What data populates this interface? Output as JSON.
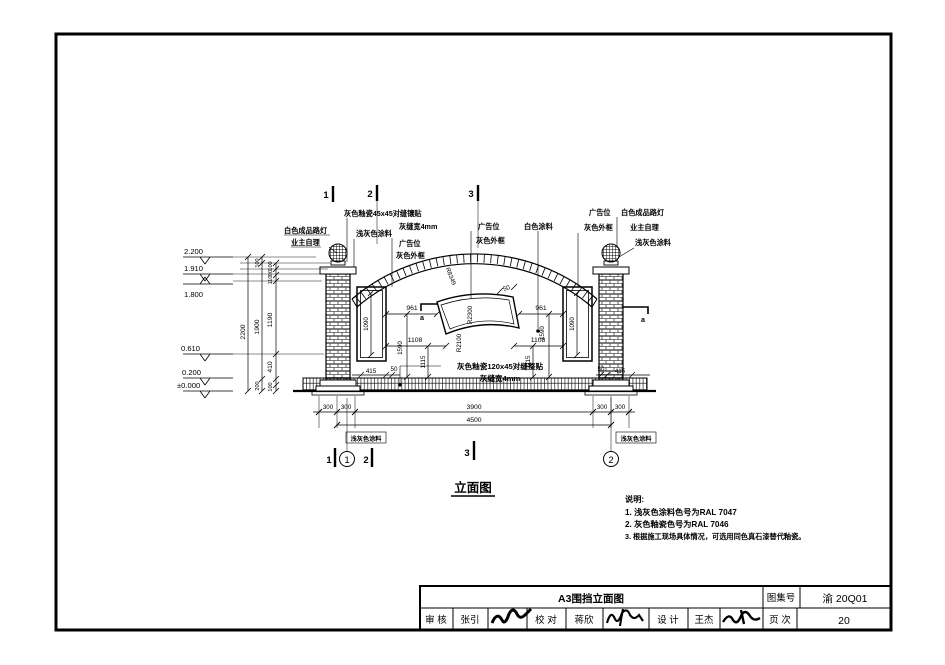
{
  "drawing": {
    "title": "立面图",
    "levels": {
      "l2200": "2.200",
      "l1910": "1.910",
      "l1800": "1.800",
      "l0610": "0.610",
      "l0200": "0.200",
      "l0000": "±0.000"
    },
    "axis": {
      "n1": "1",
      "n2": "2",
      "n3": "3",
      "a": "a"
    },
    "labels": {
      "lamp1": "白色成品路灯",
      "lamp2": "业主自理",
      "tile45": "灰色釉瓷45x45对缝镶贴",
      "joint4": "灰缝宽4mm",
      "paint_lightgray": "浅灰色涂料",
      "ad": "广告位",
      "ad_frame": "灰色外框",
      "paint_white": "白色涂料",
      "tile120": "灰色釉瓷120x45对缝整贴"
    },
    "dims": {
      "v2200": "2200",
      "v1900": "1900",
      "v200": "200",
      "c100a": "100",
      "c90": "90",
      "c110": "110",
      "c1190": "1190",
      "c410": "410",
      "c100b": "100",
      "p1090": "1090",
      "d961": "961",
      "d1108": "1108",
      "d1115": "1115",
      "d1590": "1590",
      "d415": "415",
      "d50": "50",
      "r_arch": "R8349",
      "r_top": "R2300",
      "r_bot": "R2100",
      "b300": "300",
      "b3900": "3900",
      "b4500": "4500"
    },
    "notes": {
      "heading": "说明:",
      "n1": "1. 浅灰色涂料色号为RAL 7047",
      "n2": "2. 灰色釉瓷色号为RAL 7046",
      "n3": "3. 根据施工现场具体情况，可选用同色真石漆替代釉瓷。"
    }
  },
  "titleblock": {
    "name": "A3围挡立面图",
    "atlas_label": "图集号",
    "atlas_no": "渝 20Q01",
    "page_label": "页 次",
    "page_no": "20",
    "audit_label": "审 核",
    "audit_name": "张引",
    "check_label": "校 对",
    "check_name": "蒋欣",
    "design_label": "设 计",
    "design_name": "王杰"
  }
}
